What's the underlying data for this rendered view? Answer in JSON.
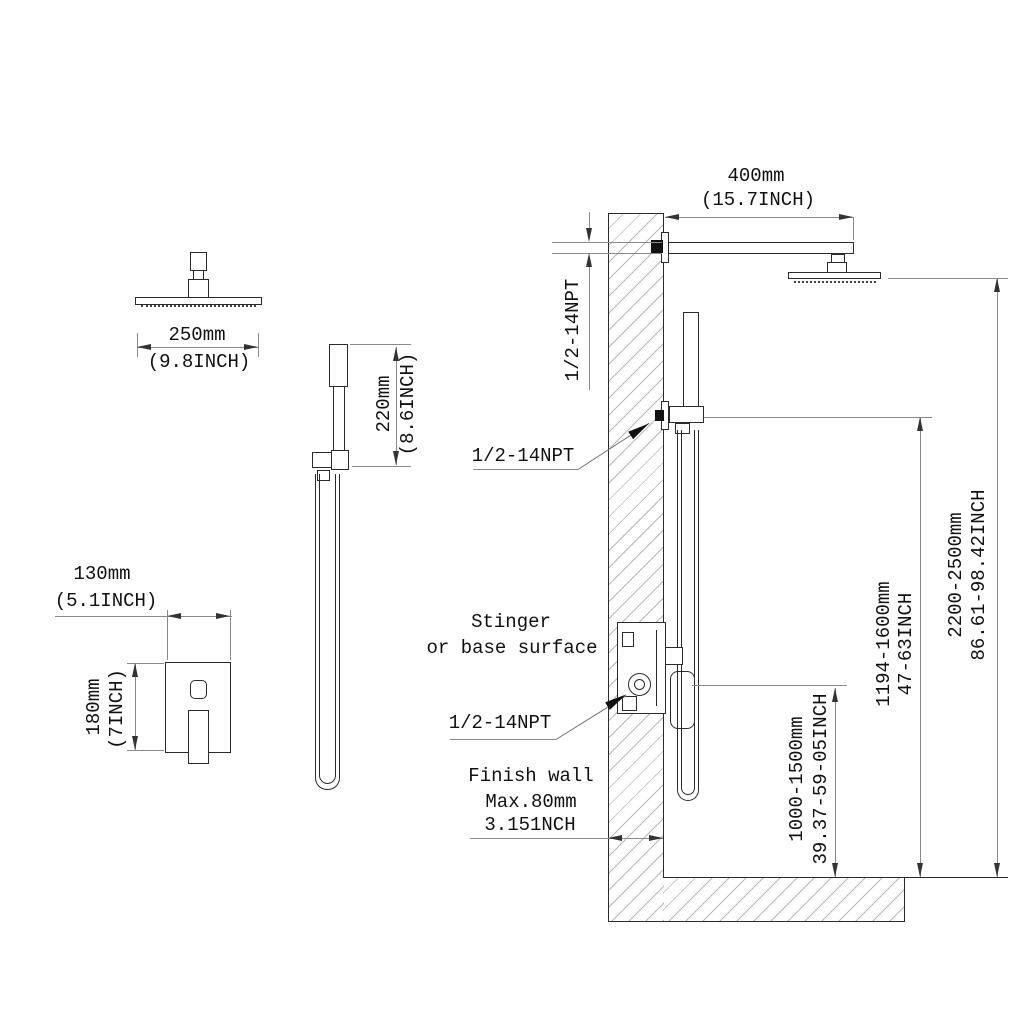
{
  "views": {
    "rain_head_front": {
      "dim_mm": "250mm",
      "dim_inch": "(9.8INCH)"
    },
    "hand_shower_front": {
      "dim_mm": "220mm",
      "dim_inch": "(8.6INCH)"
    },
    "mixer_valve_front": {
      "width_mm": "130mm",
      "width_inch": "(5.1INCH)",
      "height_mm": "180mm",
      "height_inch": "(7INCH)"
    },
    "installation_side": {
      "arm_length_mm": "400mm",
      "arm_length_inch": "(15.7INCH)",
      "npt_arm": "1/2-14NPT",
      "npt_hand_shower": "1/2-14NPT",
      "npt_valve": "1/2-14NPT",
      "surface_note_line1": "Stinger",
      "surface_note_line2": "or base surface",
      "wall_note_line1": "Finish wall",
      "wall_note_line2": "Max.80mm",
      "wall_note_line3": "3.151NCH",
      "valve_height_mm": "1000-1500mm",
      "valve_height_inch": "39.37-59-05INCH",
      "hand_shower_height_mm": "1194-1600mm",
      "hand_shower_height_inch": "47-63INCH",
      "rain_head_height_mm": "2200-2500mm",
      "rain_head_height_inch": "86.61-98.42INCH"
    }
  },
  "colors": {
    "object_line": "#2b2b2b",
    "dimension_line": "#8a8a8a",
    "hatch": "#b8b8b8",
    "fitting_fill": "#111111",
    "background": "#ffffff"
  }
}
